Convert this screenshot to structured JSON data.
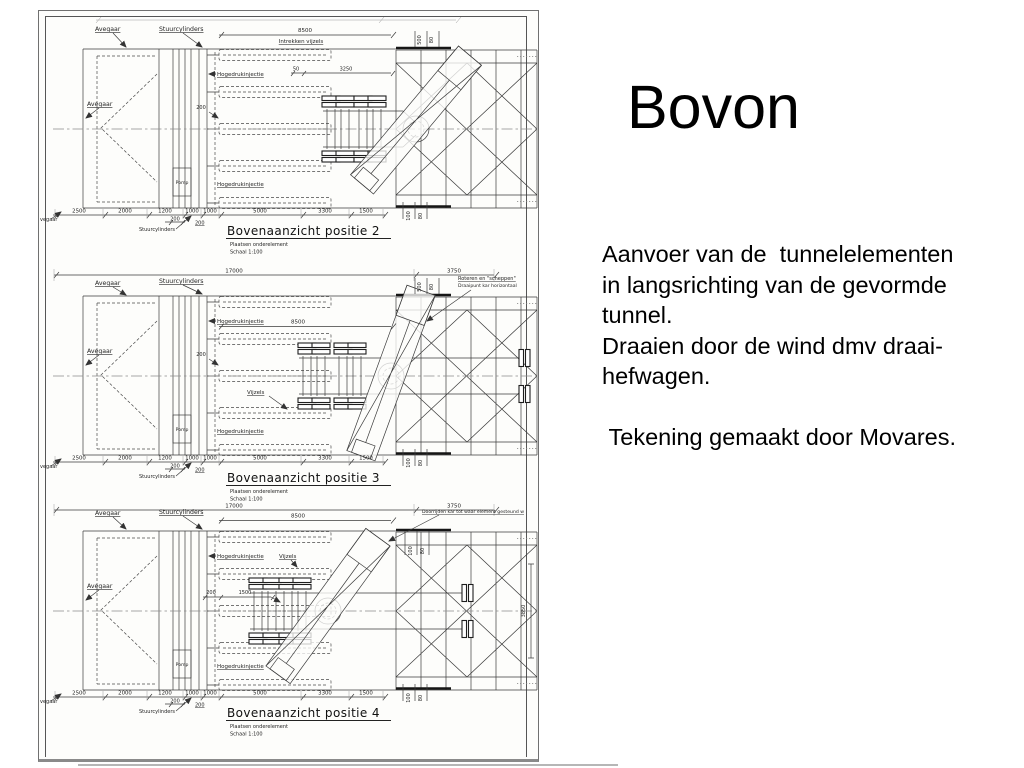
{
  "slide": {
    "title": "Bovon",
    "body": "Aanvoer van de  tunnelelementen\nin langsrichting van de gevormde\ntunnel.\nDraaien door de wind dmv draai-\nhefwagen.\n\n Tekening gemaakt door Movares."
  },
  "drawing": {
    "shared": {
      "avegaar": "Avegaar",
      "avegaar_cut": "vegaar",
      "stuurcylinders": "Stuurcylinders",
      "hogedrukinjectie": "Hogedrukinjectie",
      "pomp": "Pomp",
      "vijzels": "Vijzels",
      "subtitle": "Plaatsen onderelement",
      "schaal": "Schaal 1:100",
      "dims_bottom": [
        "2500",
        "2000",
        "1200",
        "1000",
        "1000",
        "5000",
        "3300",
        "1500"
      ],
      "dim_200": "200",
      "dim_8500": "8500",
      "dim_17000": "17000",
      "dim_3750": "3750",
      "dim_500": "500",
      "dim_100": "100",
      "dim_80": "80"
    },
    "panels": [
      {
        "title": "Bovenaanzicht positie 2",
        "intrekken_vijzels": "Intrekken vijzels",
        "dim_50": "50",
        "dim_3250": "3250"
      },
      {
        "title": "Bovenaanzicht positie 3",
        "note1": "Roteren en \"scheppen\"",
        "note2": "Draaipunt kar horizontaal"
      },
      {
        "title": "Bovenaanzicht positie 4",
        "note": "Doorrijden kar tot waar element gesteund w",
        "dim_1500": "1500",
        "dim_3850": "3850"
      }
    ]
  }
}
